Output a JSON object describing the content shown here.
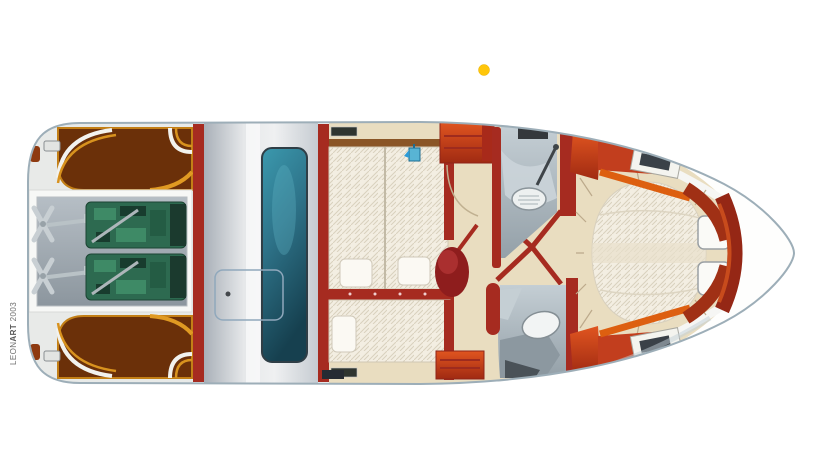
{
  "watermark": {
    "prefix": "LEON",
    "brand_bold": "ART",
    "year": "2003"
  },
  "marker": {
    "name": "yellow-dot-marker",
    "color": "#FFC60A"
  },
  "colors": {
    "hull_outline": "#9DAEB8",
    "wall_red": "#A62B20",
    "furniture_orange": "#D14A1C",
    "deck_brown": "#6B3009",
    "trim_amber": "#D8921E",
    "floor_beige": "#E9DDC0",
    "mattress_cream": "#F3EEE2",
    "engine_green": "#2D6A50",
    "wet_gray": "#AEBCC4",
    "glass_teal": "#2F7F96",
    "cockpit_silver": "#C7CDD3",
    "accent_blue": "#58B4D4"
  }
}
